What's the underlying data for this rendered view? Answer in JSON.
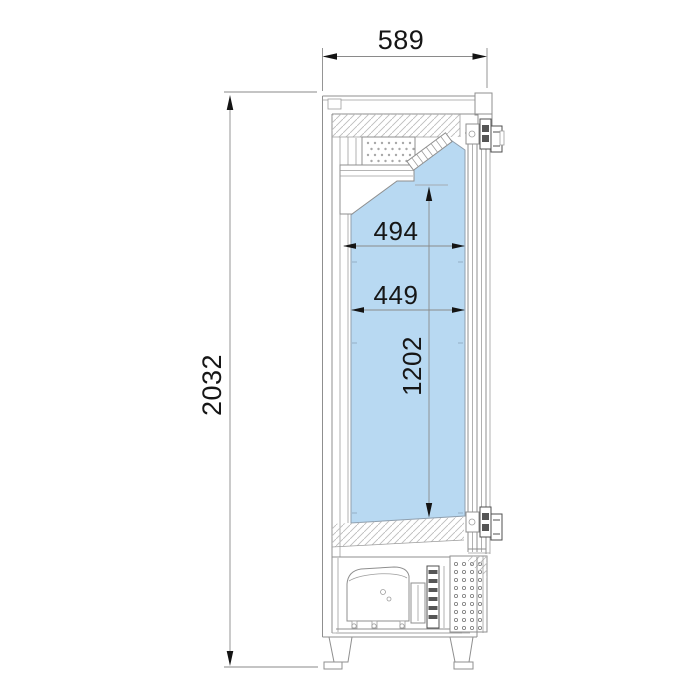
{
  "drawing": {
    "labels": {
      "overall_depth": "589",
      "overall_height": "2032",
      "interior_top_depth": "494",
      "interior_mid_depth": "449",
      "interior_height": "1202"
    },
    "colors": {
      "background": "#ffffff",
      "interior_fill": "#b8d9f2",
      "line": "#8f8f8f",
      "dark_line": "#4f4f4f",
      "dimension_text": "#161616",
      "arrow": "#141414"
    }
  }
}
